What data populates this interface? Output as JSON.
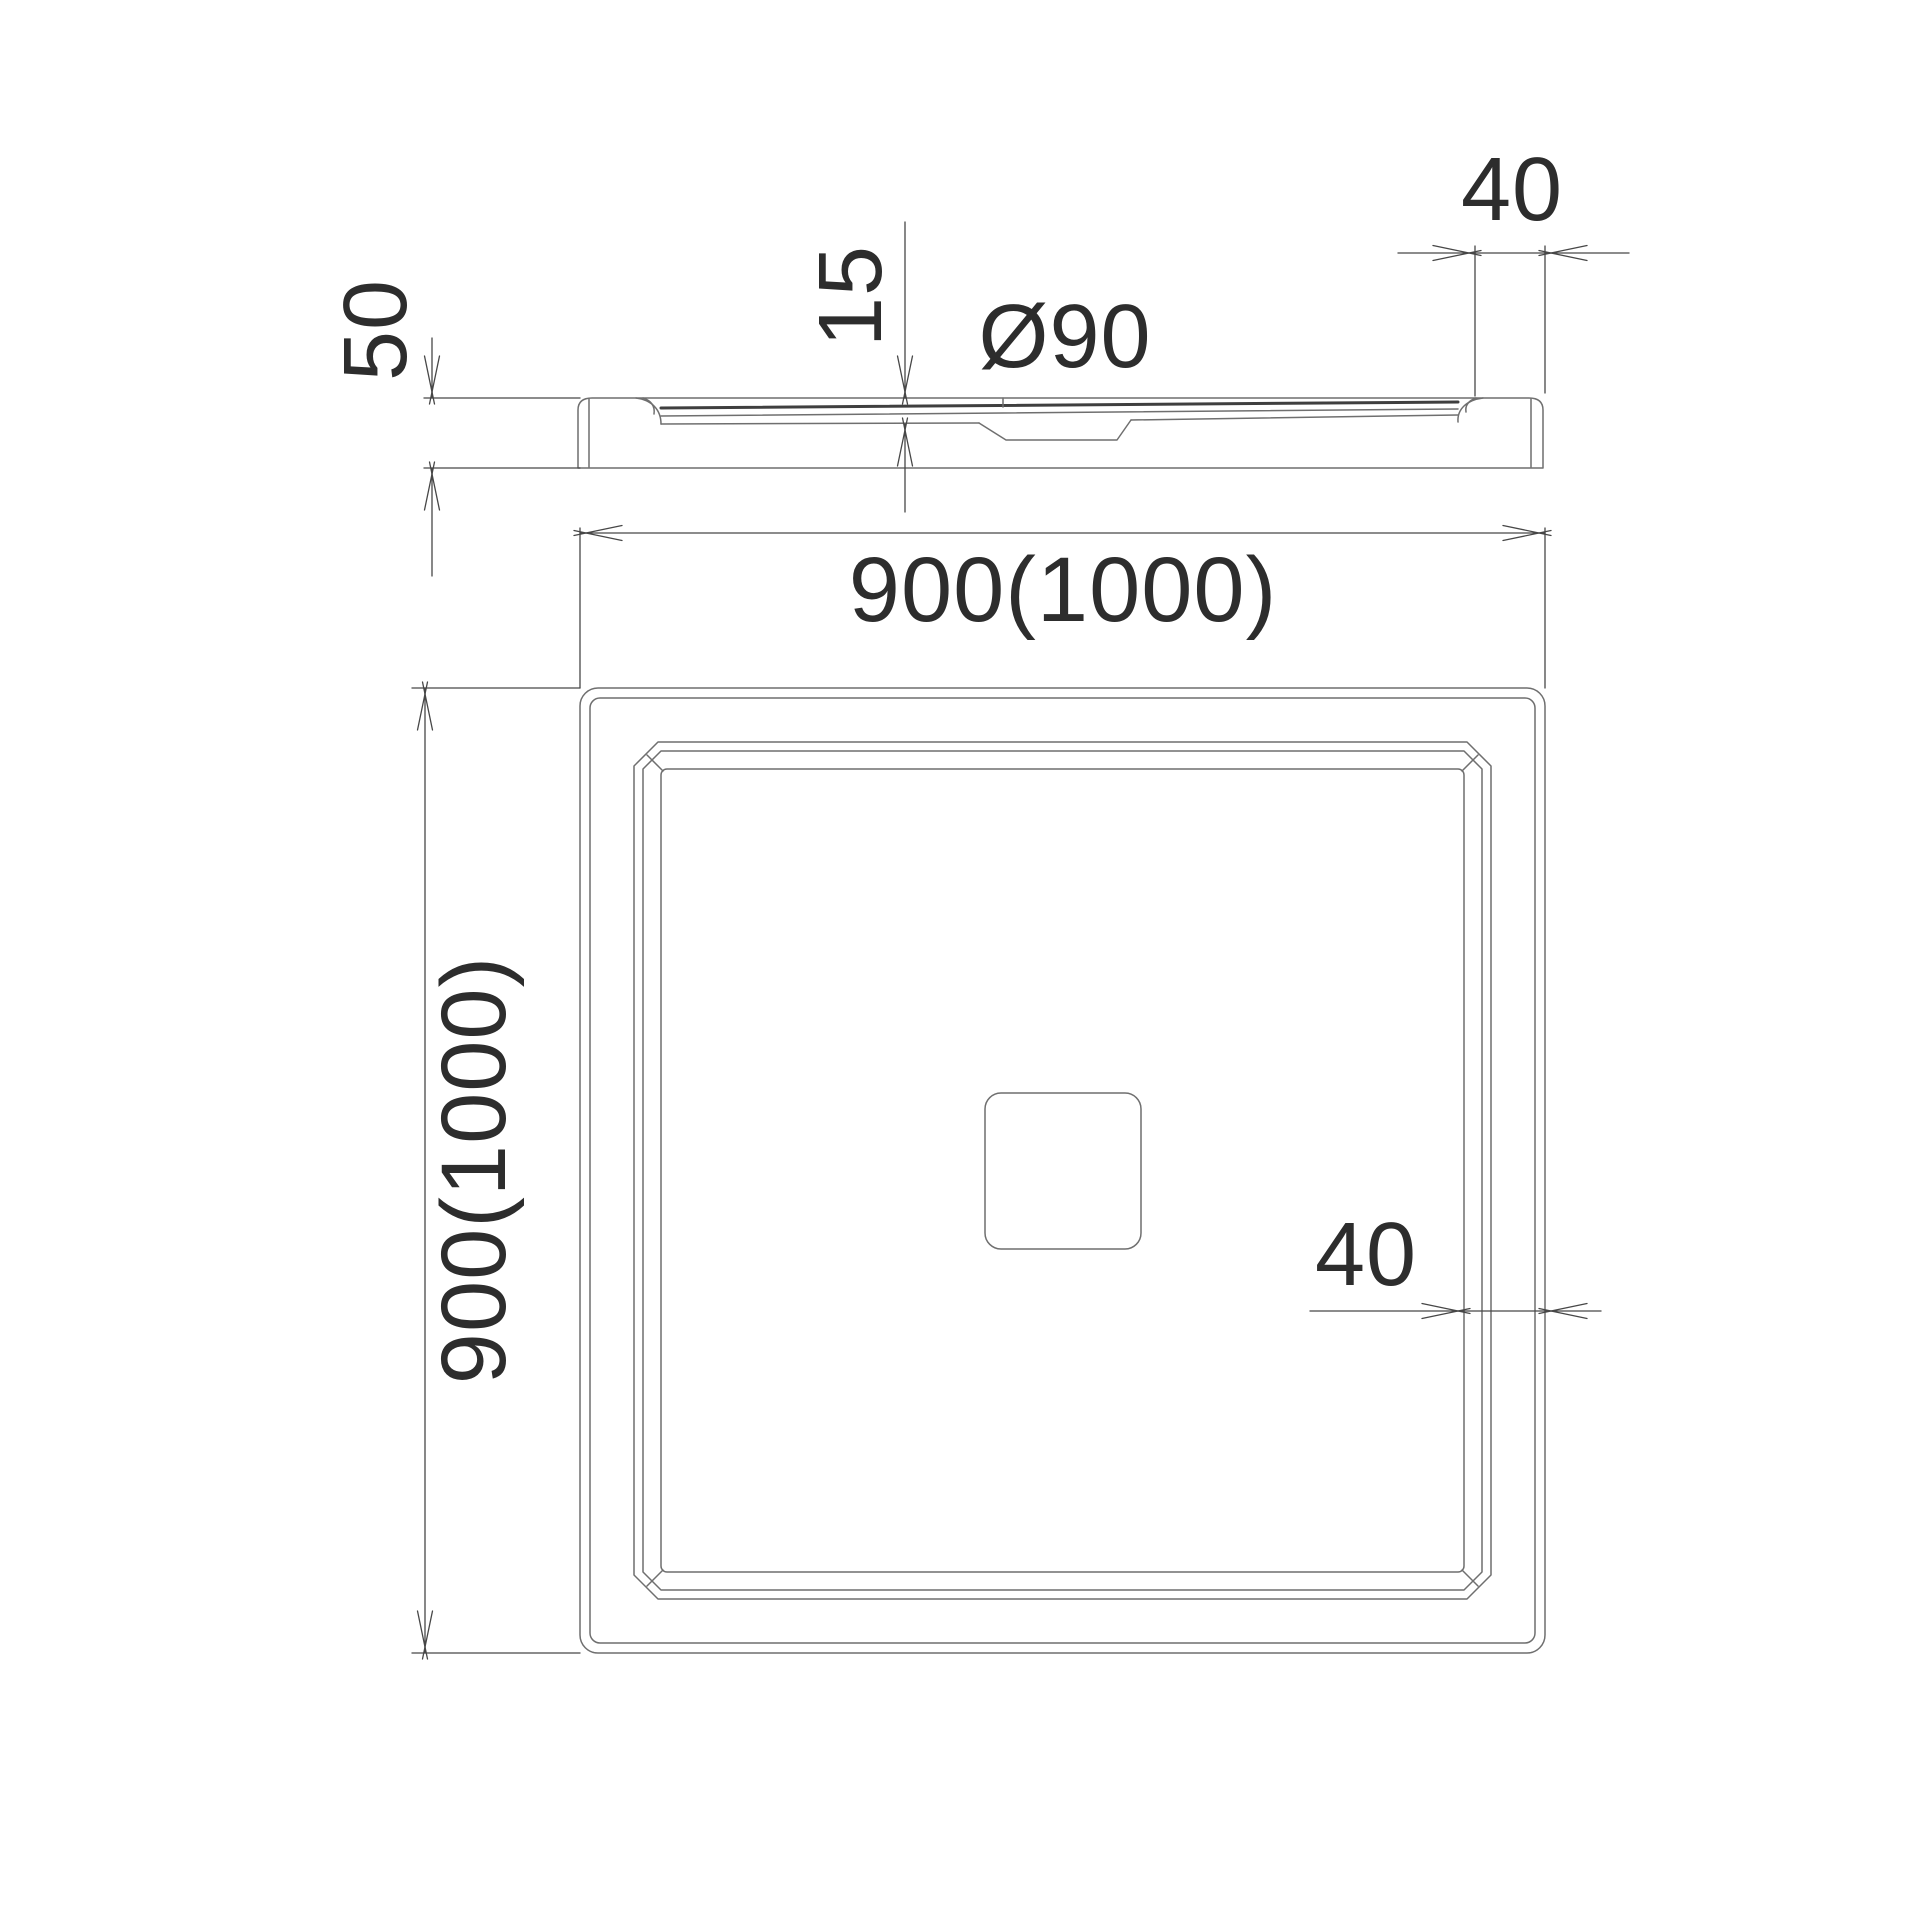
{
  "document": {
    "kind": "technical-drawing",
    "subject": "square shower tray with center drain, side elevation and plan view"
  },
  "colors": {
    "background": "#ffffff",
    "geometry_line": "#6f6f6f",
    "dimension_line": "#474747",
    "label_text": "#2d2d2d"
  },
  "labels": {
    "height_50": "50",
    "basin_depth_15": "15",
    "drain_diameter": "Ø90",
    "rim_width_side": "40",
    "overall_width": "900(1000)",
    "overall_depth": "900(1000)",
    "rim_width_plan": "40"
  }
}
